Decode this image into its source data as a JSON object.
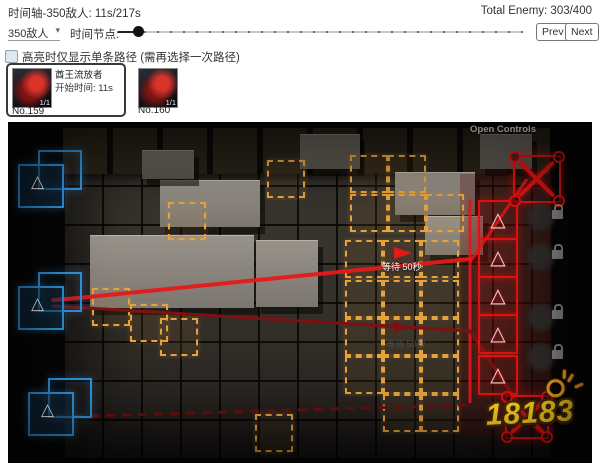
{
  "header": {
    "title": "时间轴-350敌人: 11s/217s",
    "total_enemy": "Total Enemy: 303/400"
  },
  "controls": {
    "enemy_select_value": "350敌人",
    "time_node_label": "时间节点:",
    "prev_label": "Prev",
    "next_label": "Next",
    "highlight_label": "高亮时仅显示单条路径 (需再选择一次路径)",
    "highlight_checked": false
  },
  "enemy_cards": [
    {
      "name": "酋王流放者",
      "start_time": "开始时间: 11s",
      "count_badge": "1/1",
      "number": "No.159",
      "selected": true
    },
    {
      "count_badge": "1/1",
      "number": "No.160",
      "selected": false
    }
  ],
  "map": {
    "open_controls_label": "Open Controls",
    "path_labels": [
      {
        "text": "等待 50秒"
      },
      {
        "text": "等待 50秒"
      }
    ],
    "watermark": "18183",
    "colors": {
      "path_red": "#e81818",
      "path_dark_red": "#7d1010",
      "deploy_tile_orange": "#e6a23c",
      "spawn_blue": "#3194dc",
      "exit_red": "#e01212",
      "watermark_yellow": "#fcd21c"
    }
  },
  "icons": {
    "triangle": "△",
    "caret": "▾"
  }
}
